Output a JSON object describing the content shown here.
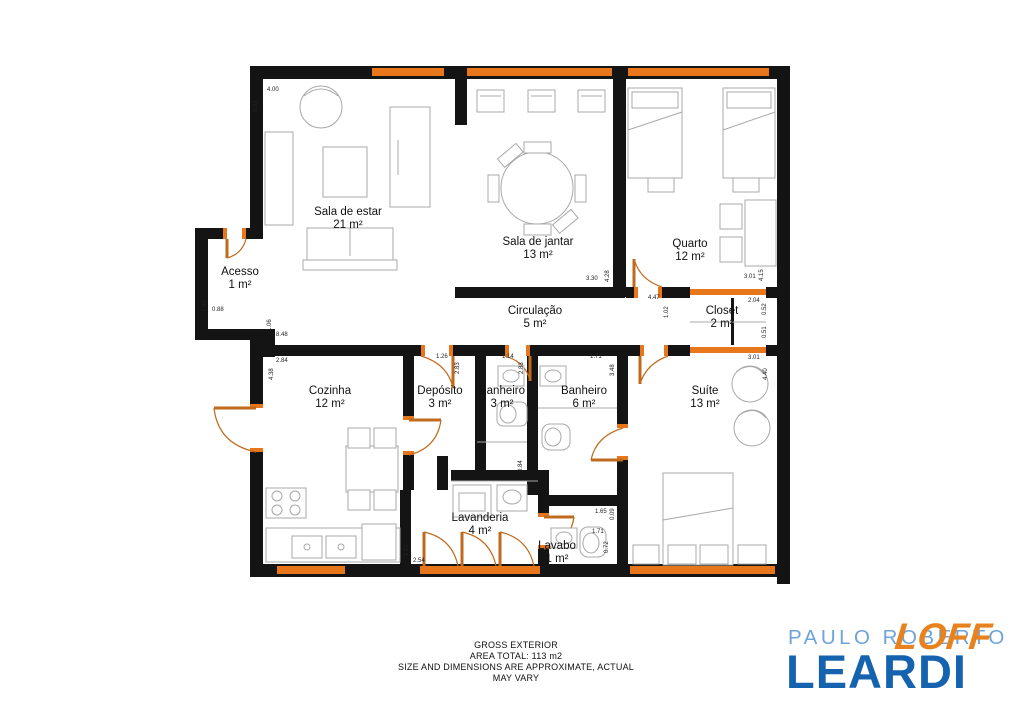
{
  "plan": {
    "rooms": [
      {
        "name": "Sala de estar",
        "area": "21 m²"
      },
      {
        "name": "Sala de jantar",
        "area": "13 m²"
      },
      {
        "name": "Quarto",
        "area": "12 m²"
      },
      {
        "name": "Acesso",
        "area": "1 m²"
      },
      {
        "name": "Circulação",
        "area": "5 m²"
      },
      {
        "name": "Closet",
        "area": "2 m²"
      },
      {
        "name": "Cozinha",
        "area": "12 m²"
      },
      {
        "name": "Depósito",
        "area": "3 m²"
      },
      {
        "name": "Banheiro",
        "area": "3 m²"
      },
      {
        "name": "Banheiro",
        "area": "6 m²"
      },
      {
        "name": "Suíte",
        "area": "13 m²"
      },
      {
        "name": "Lavanderia",
        "area": "4 m²"
      },
      {
        "name": "Lavabo",
        "area": "1 m²"
      }
    ],
    "dims": [
      "5.51",
      "4.00",
      "1.40",
      "0.88",
      "1.06",
      "8.48",
      "3.30",
      "4.28",
      "3.01",
      "4.15",
      "4.47",
      "1.02",
      "2.04",
      "0.52",
      "0.51",
      "2.84",
      "4.38",
      "1.26",
      "2.83",
      "1.14",
      "2.83",
      "1.71",
      "3.48",
      "3.01",
      "4.40",
      "0.84",
      "1.61",
      "2.54",
      "1.65",
      "0.09",
      "1.71",
      "0.72"
    ]
  },
  "footer": {
    "line1": "GROSS EXTERIOR",
    "line2": "AREA TOTAL: 113 m2",
    "line3": "SIZE AND DIMENSIONS ARE APPROXIMATE, ACTUAL",
    "line4": "MAY VARY"
  },
  "logo": {
    "top": "PAULO ROBERTO",
    "main": "LEARDI",
    "badge": "LOFF"
  },
  "colors": {
    "wall": "#141414",
    "window_door": "#E8761B",
    "door_arc": "#C06A1C",
    "furniture": "#A8A8A8",
    "logo_light_blue": "#6EA4D9",
    "logo_dark_blue": "#1563AE",
    "logo_orange": "#E8821E"
  }
}
